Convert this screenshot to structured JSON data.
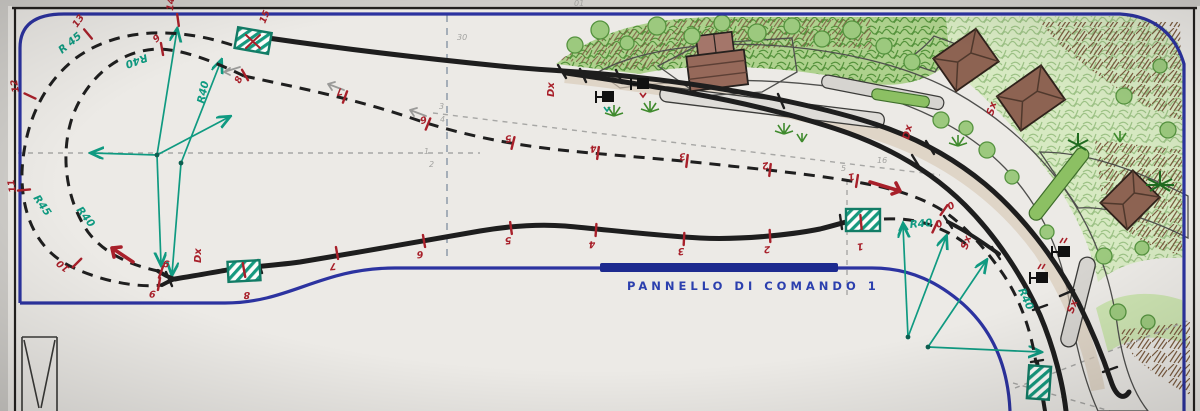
{
  "panel_label": "PANNELLO DI COMANDO 1",
  "sections": {
    "outer_loop": [
      "15",
      "14",
      "13",
      "12",
      "11",
      "10",
      "9",
      "9"
    ],
    "inner_loop": [
      "9",
      "8"
    ],
    "hidden_return": [
      "7",
      "6",
      "5",
      "4",
      "3",
      "2",
      "1",
      "0",
      "0"
    ],
    "front_track": [
      "8",
      "7",
      "6",
      "5",
      "4",
      "3",
      "2",
      "1"
    ]
  },
  "turnouts": {
    "dx": [
      "Dx",
      "Dx",
      "Dx"
    ],
    "sx": [
      "Sx",
      "Sx",
      "Sx"
    ]
  },
  "radii": [
    "R 45",
    "R40",
    "R40",
    "R45",
    "R40",
    "R40",
    "R40"
  ],
  "pencil_notes": [
    "30",
    "01",
    "3",
    "4",
    "1",
    "2",
    "16",
    "5"
  ],
  "colors": {
    "layout_border_blue": "#2c33a0",
    "panel_bar_blue": "#1d2a8f",
    "track_black": "#1e1e1e",
    "section_mark_red": "#a8202a",
    "construction_teal": "#0f9a81",
    "pencil_gray": "#a7a7a5",
    "handwriting_blue": "#2b3fae",
    "road_gray": "#c9c7c3",
    "building_brown": "#96695a",
    "foliage_green": "#6aa84f"
  }
}
